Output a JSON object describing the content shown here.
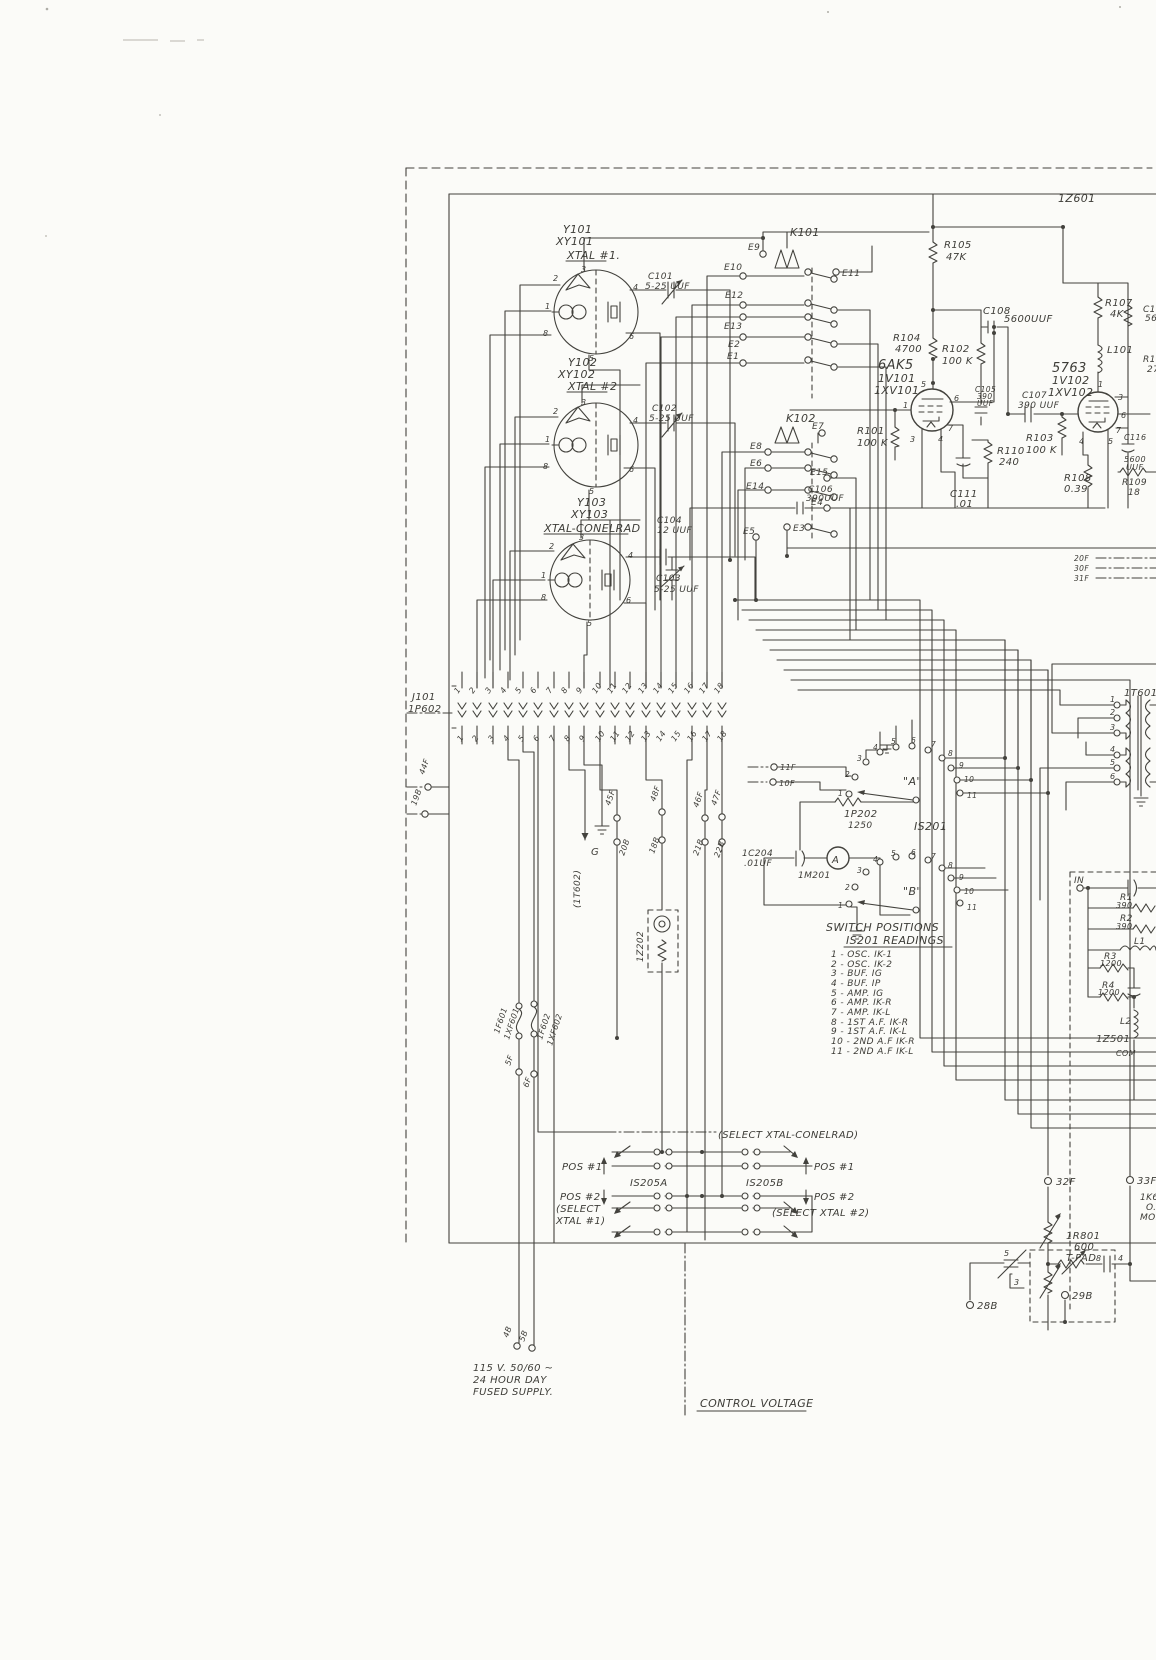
{
  "colors": {
    "paper": "#fbfbf8",
    "ink": "#43423d"
  },
  "unit": {
    "z601": "1Z601",
    "control_voltage": "CONTROL VOLTAGE"
  },
  "crystals": {
    "y101": {
      "ref": "Y101",
      "ref2": "XY101",
      "name": "XTAL #1.",
      "pins": [
        "2",
        "3",
        "4",
        "1",
        "8",
        "6",
        "5"
      ]
    },
    "y102": {
      "ref": "Y102",
      "ref2": "XY102",
      "name": "XTAL #2",
      "pins": [
        "2",
        "3",
        "4",
        "1",
        "8",
        "6",
        "5"
      ]
    },
    "y103": {
      "ref": "Y103",
      "ref2": "XY103",
      "name": "XTAL-CONELRAD",
      "pins": [
        "2",
        "3",
        "4",
        "1",
        "8",
        "6",
        "5"
      ]
    }
  },
  "caps": {
    "c101": {
      "ref": "C101",
      "val": "5-25 UUF"
    },
    "c102": {
      "ref": "C102",
      "val": "5-25 UUF"
    },
    "c103": {
      "ref": "C103",
      "val": "5-25 UUF"
    },
    "c104": {
      "ref": "C104",
      "val": "12 UUF"
    },
    "c105": {
      "ref": "C105",
      "v1": "390",
      "v2": "UUF"
    },
    "c106": {
      "ref": "C106",
      "val": "390UUF"
    },
    "c107": {
      "ref": "C107",
      "val": "390 UUF"
    },
    "c108": {
      "ref": "C108",
      "val": "5600UUF"
    },
    "c109": {
      "ref": "C109",
      "val": "560"
    },
    "c111": {
      "ref": "C111",
      "val": ".01"
    },
    "c116": {
      "ref": "C116",
      "v1": "5600",
      "v2": "UUF"
    },
    "c204": {
      "ref": "1C204",
      "val": ".01UF"
    }
  },
  "resistors": {
    "r101": {
      "ref": "R101",
      "val": "100 K"
    },
    "r102": {
      "ref": "R102",
      "val": "100 K"
    },
    "r103": {
      "ref": "R103",
      "val": "100 K"
    },
    "r104": {
      "ref": "R104",
      "val": "4700"
    },
    "r105": {
      "ref": "R105",
      "val": "47K"
    },
    "r106": {
      "ref": "R106",
      "val": "27"
    },
    "r107": {
      "ref": "R107",
      "val": "4K"
    },
    "r108": {
      "ref": "R108",
      "val": "0.39"
    },
    "r109": {
      "ref": "R109",
      "val": "18"
    },
    "r110": {
      "ref": "R110",
      "val": "240"
    },
    "rp202": {
      "ref": "1P202",
      "val": "1250"
    }
  },
  "inductors": {
    "l101": "L101"
  },
  "tubes": {
    "v101": {
      "type": "6AK5",
      "ref": "1V101",
      "socket": "1XV101",
      "pins": [
        "5",
        "1",
        "6",
        "7",
        "3",
        "4"
      ]
    },
    "v102": {
      "type": "5763",
      "ref": "1V102",
      "socket": "1XV102",
      "pins": [
        "1",
        "3",
        "6",
        "7",
        "5",
        "4"
      ]
    }
  },
  "relays": {
    "k101": {
      "ref": "K101",
      "terminals": [
        "E9",
        "E10",
        "E11",
        "E12",
        "E13",
        "E2",
        "E1"
      ]
    },
    "k102": {
      "ref": "K102",
      "terminals": [
        "E7",
        "E8",
        "E6",
        "E14",
        "E15",
        "E4",
        "E5",
        "E3"
      ]
    }
  },
  "connector": {
    "jack": "J101",
    "plug": "1P602",
    "pins": [
      "1",
      "2",
      "3",
      "4",
      "5",
      "6",
      "7",
      "8",
      "9",
      "10",
      "11",
      "12",
      "13",
      "14",
      "15",
      "16",
      "17",
      "18"
    ]
  },
  "terminals": {
    "t44f": "44F",
    "t19b": "19B",
    "t45f": "45F",
    "t20b": "20B",
    "t48f": "48F",
    "t18b": "18B",
    "t46f": "46F",
    "t21b": "21B",
    "t47f": "47F",
    "t22b": "22B",
    "t11f": "11F",
    "t10f": "10F",
    "t20f": "20F",
    "t30f": "30F",
    "t31f": "31F",
    "t5f": "5F",
    "t6f": "6F",
    "t4b": "4B",
    "t5b": "5B",
    "t32f": "32F",
    "t33f": "33F",
    "t28b": "28B",
    "t29b": "29B",
    "g": "G",
    "t1602": "(1T602)",
    "in": "IN",
    "com": "COM"
  },
  "meter": {
    "ref": "1M201",
    "glyph": "A"
  },
  "switch_s201": {
    "ref": "IS201",
    "sec_a": "\"A\"",
    "sec_b": "\"B\"",
    "positions": [
      "1",
      "2",
      "3",
      "4",
      "5",
      "6",
      "7",
      "8",
      "9",
      "10",
      "11"
    ]
  },
  "readings": {
    "title1": "SWITCH POSITIONS",
    "title2": "IS201 READINGS",
    "items": [
      "1 - OSC.  IK-1",
      "2 - OSC.  IK-2",
      "3 - BUF.  IG",
      "4 - BUF.  IP",
      "5 - AMP.  IG",
      "6 - AMP.  IK-R",
      "7 - AMP.  IK-L",
      "8 - 1ST A.F.  IK-R",
      "9 - 1ST A.F.  IK-L",
      "10 - 2ND A.F  IK-R",
      "11 - 2ND A.F  IK-L"
    ]
  },
  "lamp": {
    "ref": "1Z202"
  },
  "fuses": {
    "f1": "1F601",
    "f1x": "1XF601",
    "f2": "1F602",
    "f2x": "1XF602"
  },
  "select": {
    "conelrad": "(SELECT XTAL-CONELRAD)",
    "pos1_l": "POS #1",
    "pos2_l": "POS #2",
    "sel1a": "(SELECT",
    "sel1b": "XTAL #1)",
    "pos1_r": "POS #1",
    "pos2_r": "POS #2",
    "sel2": "(SELECT XTAL #2)",
    "sw_a": "IS205A",
    "sw_b": "IS205B"
  },
  "power": {
    "line1": "115 V.  50/60 ~",
    "line2": "24 HOUR DAY",
    "line3": "FUSED SUPPLY."
  },
  "tpad": {
    "ref": "1R801",
    "val": "600",
    "name": "T-PAD",
    "pins": [
      "5",
      "3",
      "8",
      "4"
    ]
  },
  "mod": {
    "l1": "1K601",
    "l2": "O.L.",
    "l3": "MOD"
  },
  "t601": {
    "ref": "1T601",
    "pins": [
      "1",
      "2",
      "3",
      "4",
      "5",
      "6"
    ]
  },
  "audio": {
    "r1": "R1",
    "r1v": "390",
    "r2": "R2",
    "r2v": "390",
    "l1": "L1",
    "r3": "R3",
    "r3v": "1200",
    "r4": "R4",
    "r4v": "1200",
    "l2": "L2",
    "z": "1Z501"
  }
}
